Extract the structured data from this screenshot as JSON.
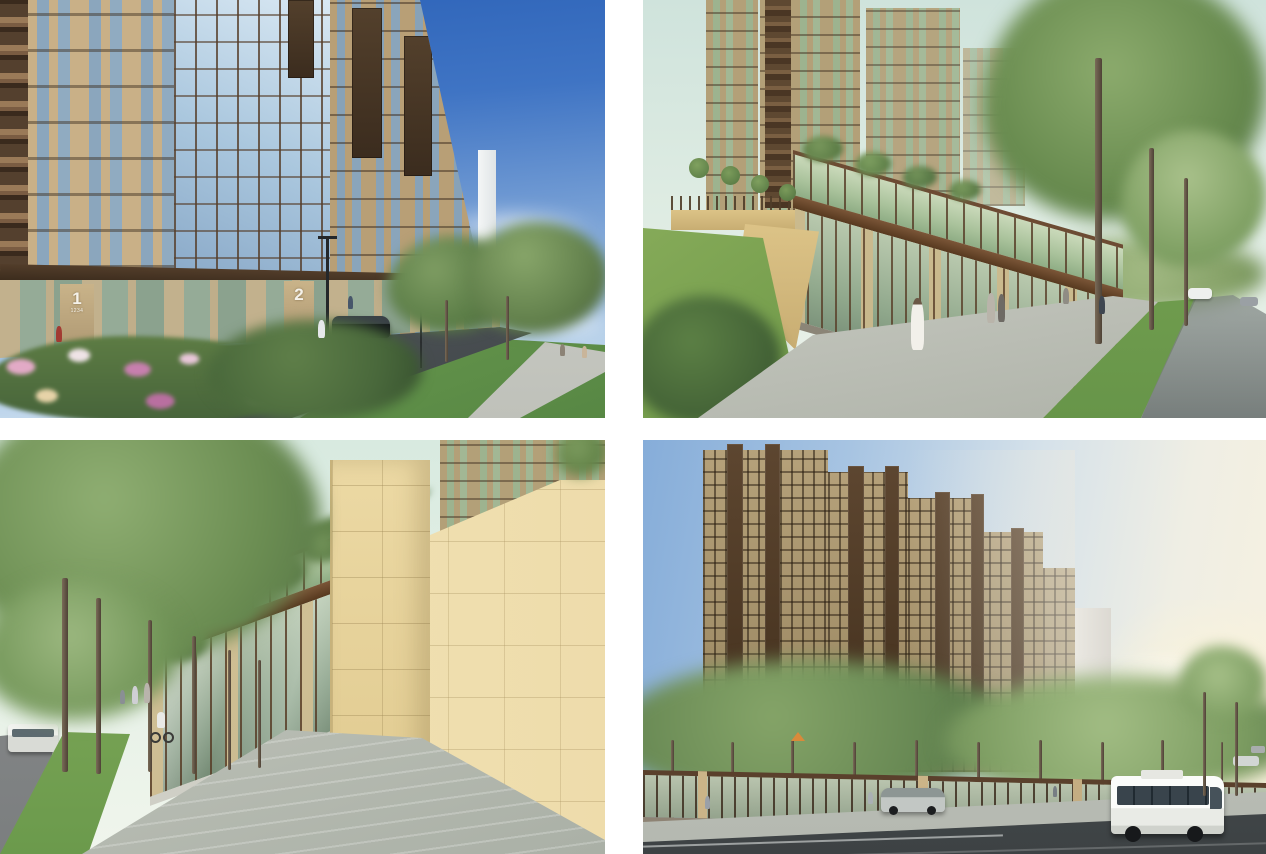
{
  "document": {
    "type": "architectural-renders-sheet",
    "layout": "2x2 grid of exterior renderings of a residential complex separated by white gutters",
    "background": "#ffffff"
  },
  "panels": [
    {
      "name": "render-top-left",
      "description": "Street-corner view of a beige multi-storey residential tower with brown balcony stacks, a rounded glazed corner bay, dark ground-floor canopy over shopfronts, numbered entrances, flower beds, lawn, trees, street lamps and a dark car under a deep blue sky",
      "entrance_signs": [
        {
          "number": "1",
          "subtext": "1234"
        },
        {
          "number": "2",
          "subtext": ""
        }
      ]
    },
    {
      "name": "render-top-right",
      "description": "Sidewalk view along the stylobate: glass shopfronts with a planted glass-railed terrace above, brown cornices, yellow retaining wall and green slope on the left, towers rising behind, tall slender trees, pedestrians and a road with cars on the right",
      "entrance_signs": []
    },
    {
      "name": "render-bottom-left",
      "description": "Paved pedestrian promenade between a row of tall trees and the stylobate glass shopfronts; beige stone stair tower and angled stone wall on the right, stairs, cyclist and walkers on the path, bus and cars on the road at far left",
      "entrance_signs": []
    },
    {
      "name": "render-bottom-right",
      "description": "Panoramic view of the stepped residential complex with dark brown balcony bays behind a row of green trees and a glazed street fence; city road in front with a white coach bus, a silver car and distant vehicles under a warm evening sky",
      "entrance_signs": []
    }
  ],
  "colors": {
    "sky_deep_blue": "#3a6fc0",
    "sky_pale_green": "#dcebe4",
    "sky_warm_horizon": "#f5efdf",
    "facade_beige": "#c7ae83",
    "facade_tan_dark": "#a5926e",
    "frame_brown": "#5a432e",
    "glass_blue": "#a9c4da",
    "glass_green": "#aec2a4",
    "stone_yellow": "#e3cf9b",
    "tree_green": "#6d9355",
    "lawn_green": "#74a355",
    "pavement_light": "#c2c5bd",
    "asphalt": "#565c5e",
    "bus_white": "#f4f5f2"
  }
}
